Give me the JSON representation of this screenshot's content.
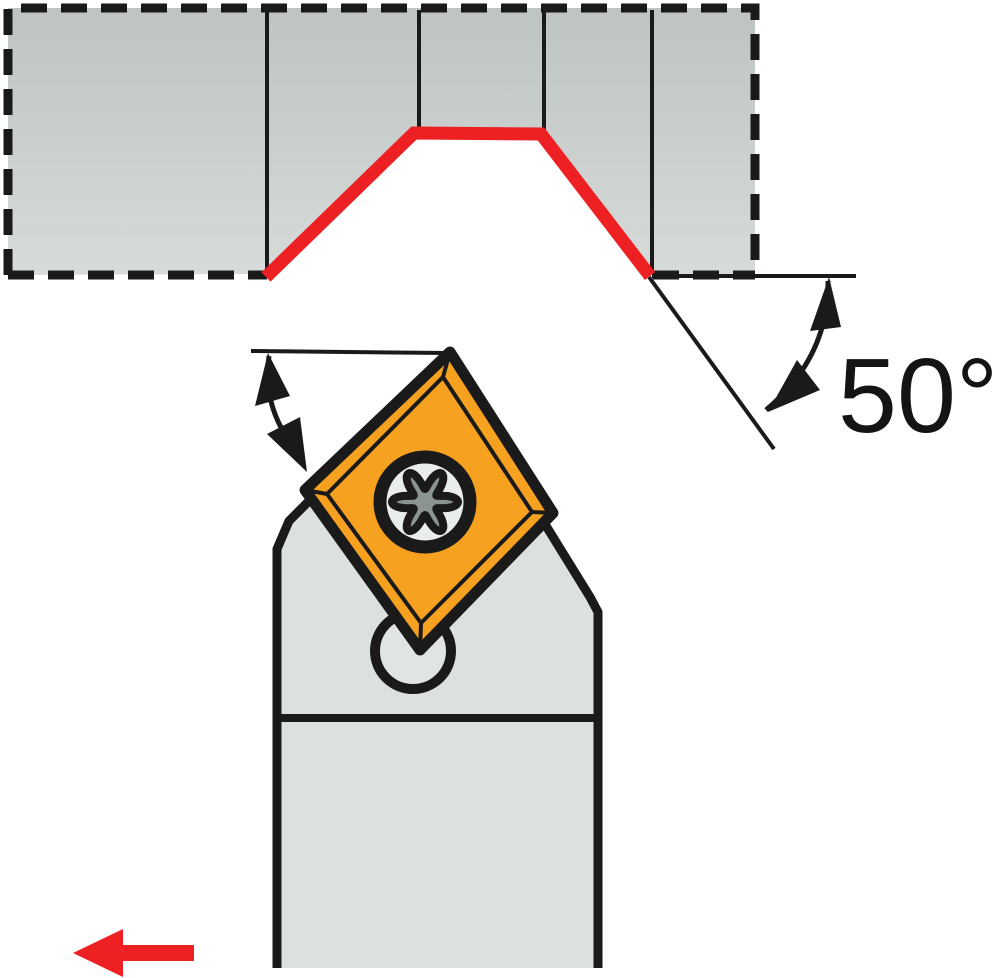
{
  "angle_annotation": {
    "label": "50°",
    "degrees": 50
  },
  "colors": {
    "background": "#ffffff",
    "ink": "#1a1a1a",
    "highlight_red": "#ED2024",
    "insert_orange": "#F6A11F",
    "holder_gray": "#DCE1DF",
    "workpiece_top": "#BDC4C2",
    "workpiece_bottom": "#D7DBD9",
    "pin_gray": "#E0E5E3",
    "screw_ring": "#E9EDEB",
    "screw_star": "#8A9593"
  },
  "icons": {
    "feed_direction_arrow": "red-arrow-left",
    "entering_angle_arrow": "curved-double-arrow",
    "insert_angle_arrow": "curved-double-arrow",
    "screw": "torx-screw"
  }
}
